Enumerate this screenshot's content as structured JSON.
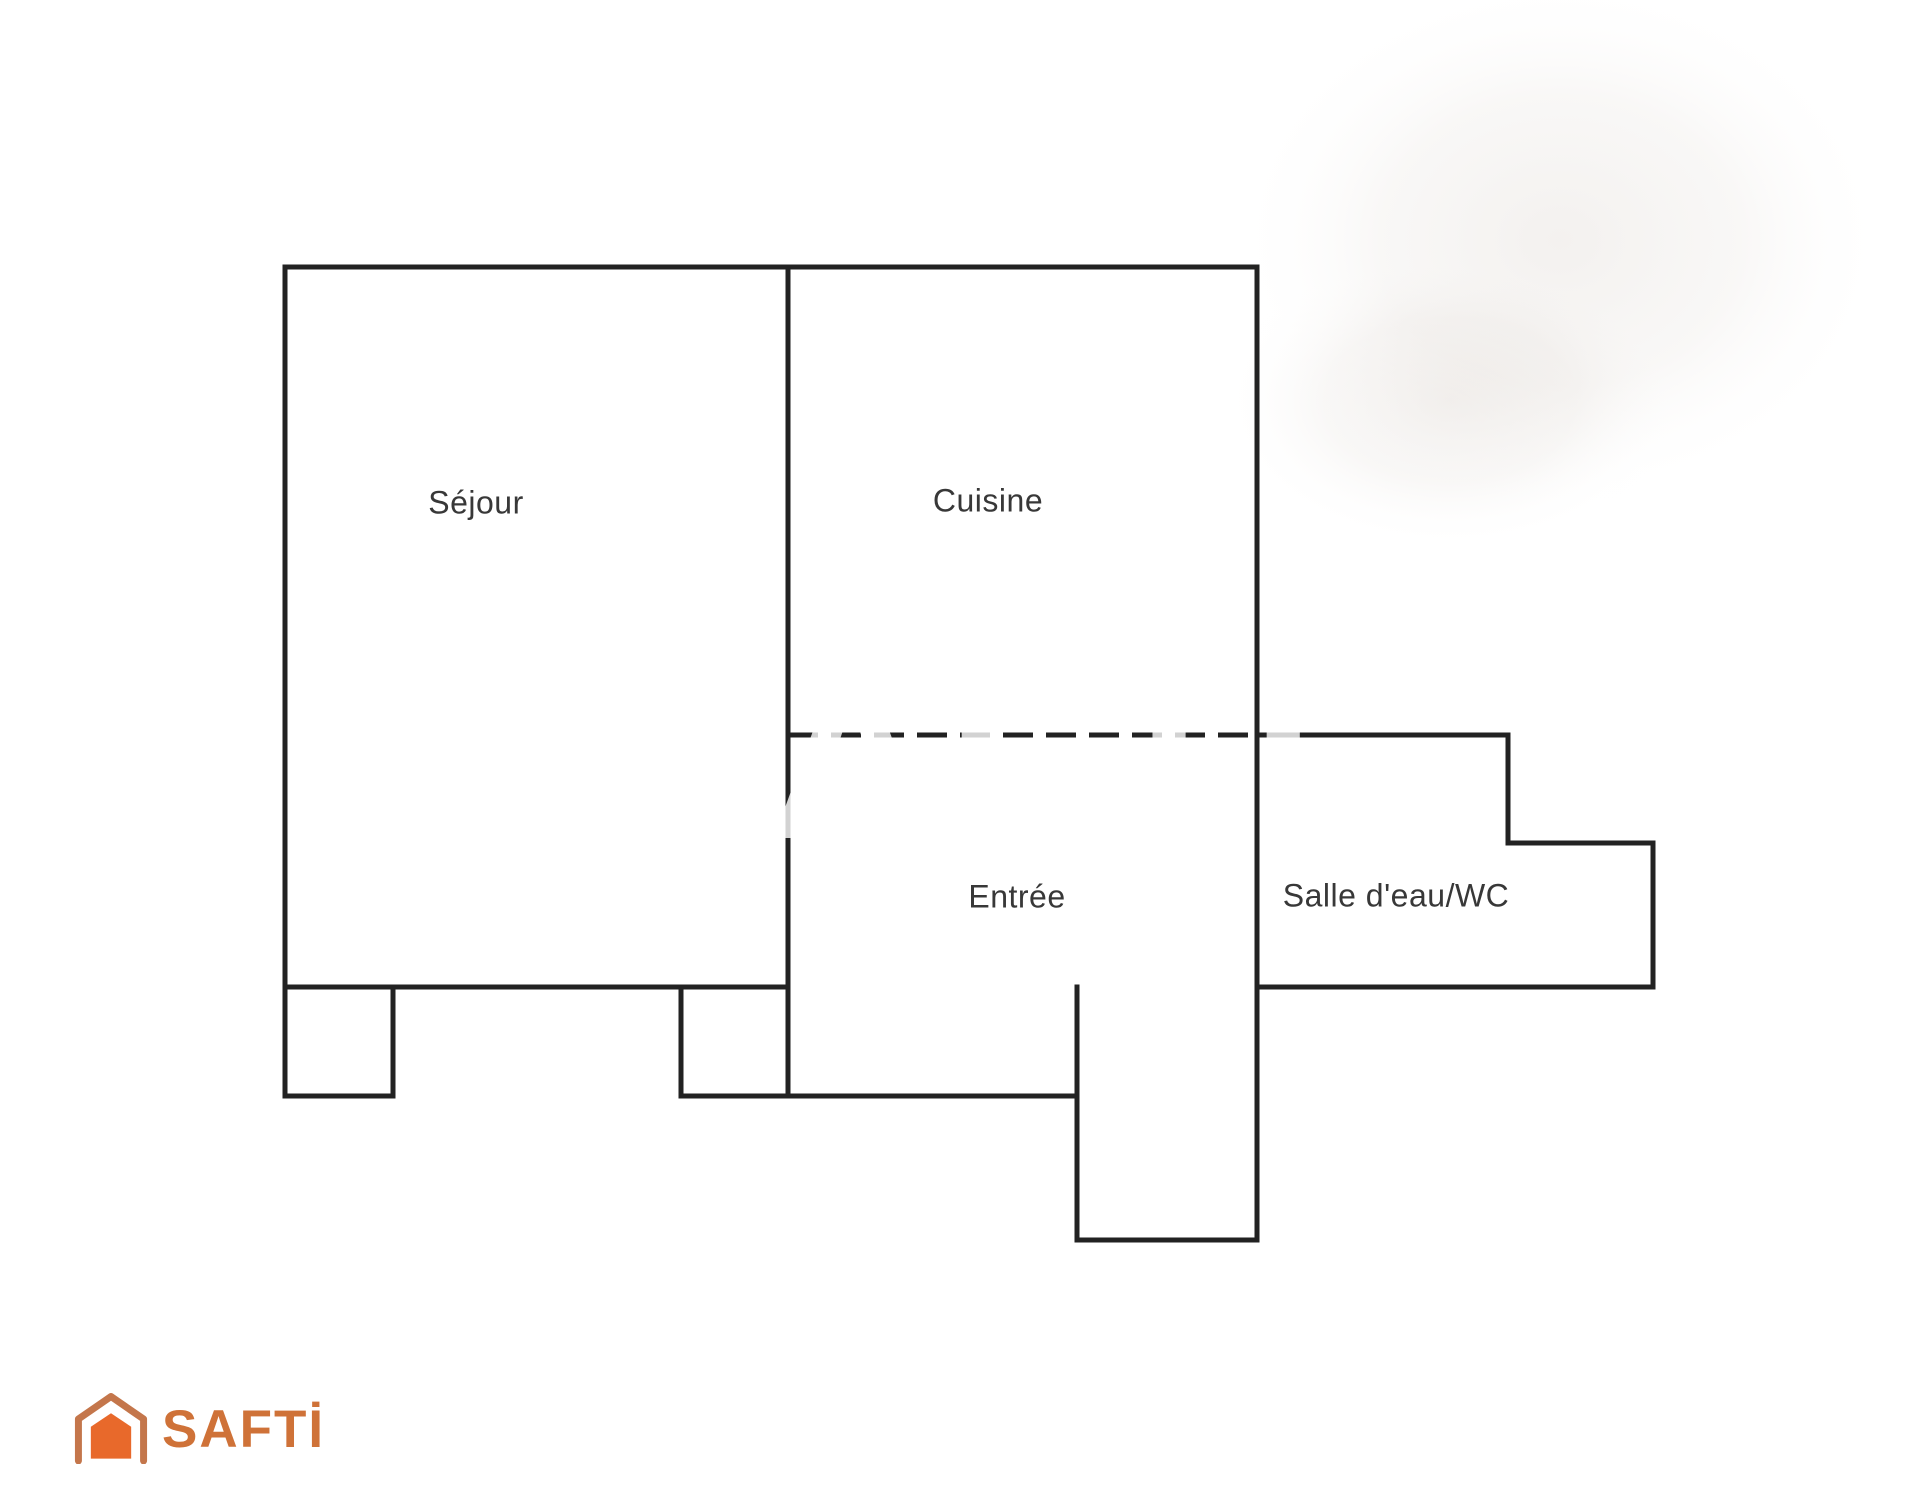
{
  "page": {
    "background": "#ffffff"
  },
  "floorplan": {
    "wall_color": "#222222",
    "label_color": "#383838",
    "rooms": [
      {
        "id": "sejour",
        "label": "Séjour"
      },
      {
        "id": "cuisine",
        "label": "Cuisine"
      },
      {
        "id": "entree",
        "label": "Entrée"
      },
      {
        "id": "salle-eau",
        "label": "Salle d'eau/WC"
      }
    ]
  },
  "watermark": {
    "text": "SAFTI"
  },
  "logo": {
    "text": "SAFTİ",
    "brand_color": "#cf7238",
    "house_fill": "#e8692b",
    "house_outline": "#c4764b"
  }
}
